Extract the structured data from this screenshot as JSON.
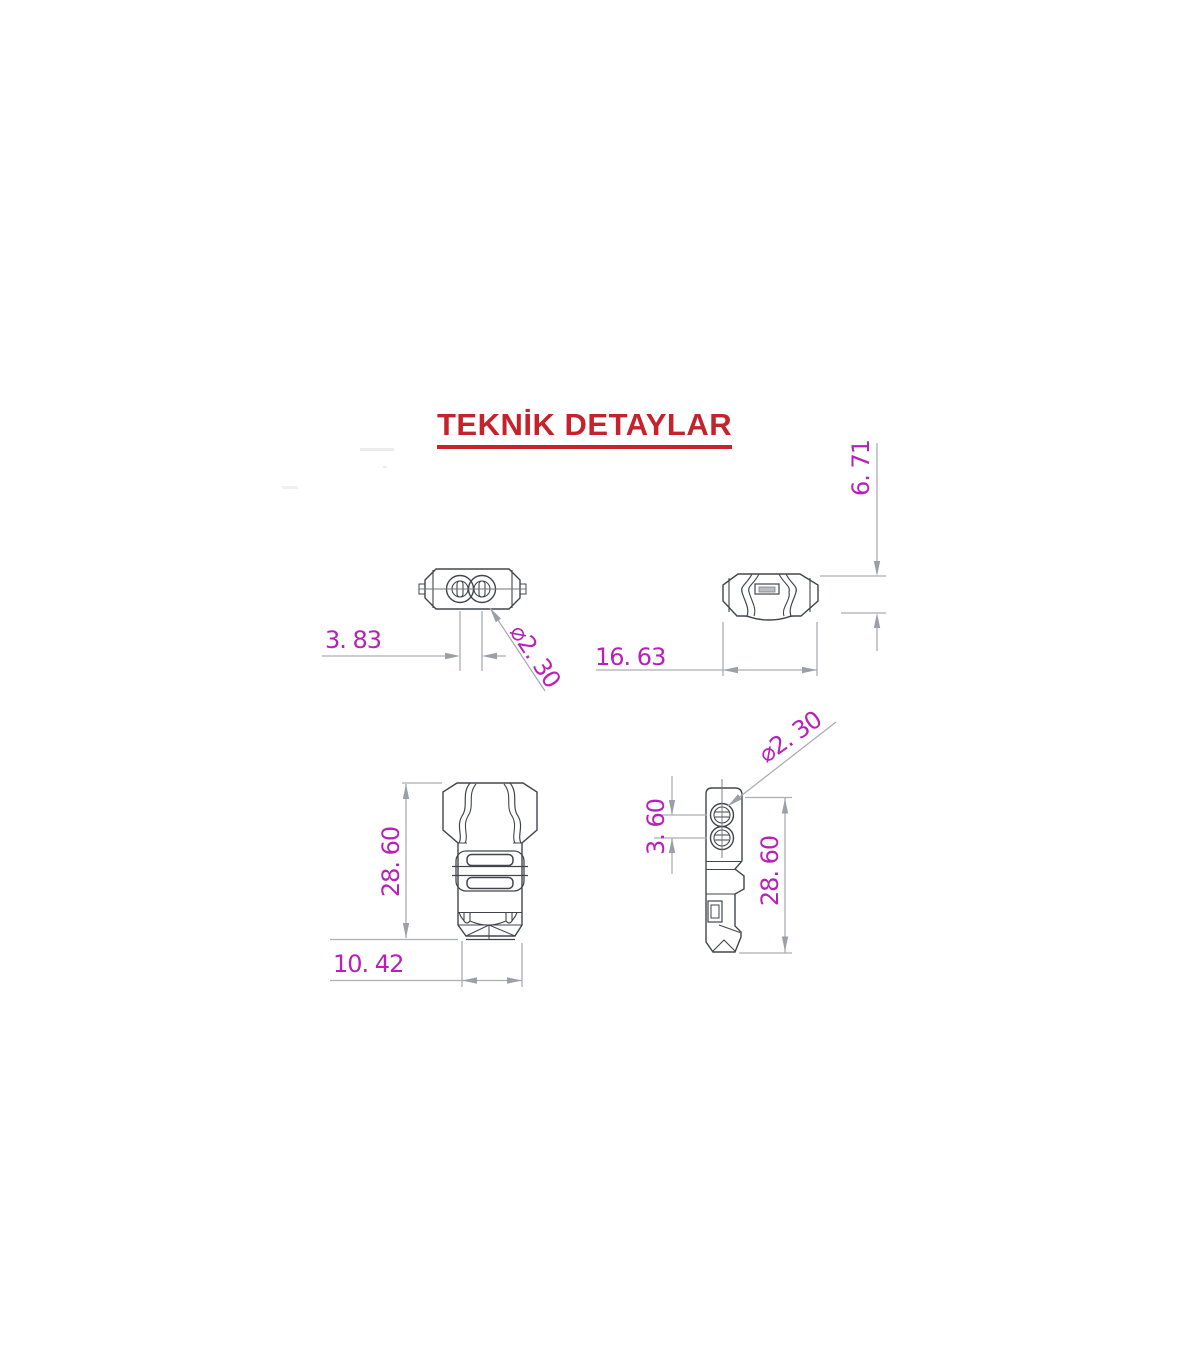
{
  "title": "TEKNİK DETAYLAR",
  "drawing": {
    "views": {
      "top": {
        "name": "top view (plug face)",
        "label_hole_spacing": "3. 83",
        "label_hole_diameter": "⌀2. 30"
      },
      "rear": {
        "name": "rear view",
        "label_width": "16. 63",
        "label_height": "6. 71"
      },
      "front": {
        "name": "front view",
        "label_height": "28. 60",
        "label_width": "10. 42"
      },
      "side": {
        "name": "side view",
        "label_hole_diameter": "⌀2. 30",
        "label_hole_spacing": "3. 60",
        "label_height": "28. 60"
      }
    }
  },
  "colors": {
    "title_red": "#c4232b",
    "dimension_magenta": "#b821b8",
    "part_outline": "#42464c",
    "dimension_line": "#abaeb3",
    "arrow_fill": "#9aa0a7"
  }
}
